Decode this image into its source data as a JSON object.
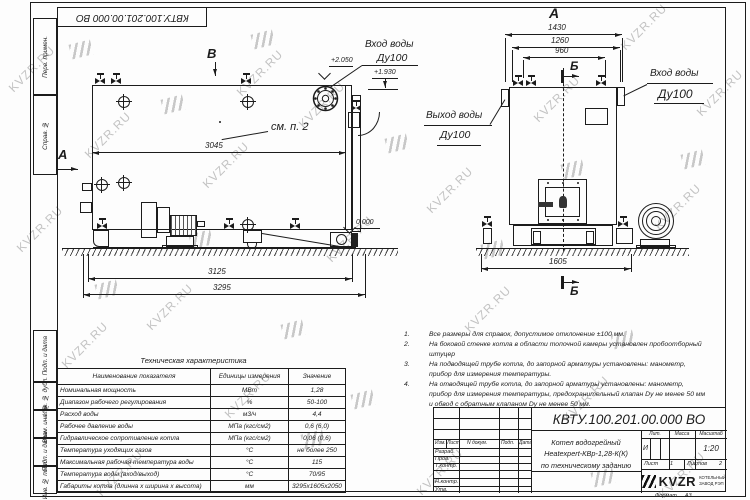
{
  "watermark": {
    "text": "KVZR.RU"
  },
  "frame": {
    "doc_number_top": "КВТУ.100.201.00.000 ВО",
    "format_label": "Формат",
    "format_value": "А3",
    "margin_boxes": [
      "Перв. примен.",
      "Справ. №",
      "Подп. и дата",
      "Инв. № дубл.",
      "Взам. инв. №",
      "Подп. и дата",
      "Инв. № подл."
    ]
  },
  "side_view": {
    "view_mark_b": "В",
    "view_mark_a": "А",
    "callout_see_p2": "см. п. 2",
    "inlet_label": "Вход воды",
    "inlet_dn": "Ду100",
    "lvl_top": "+2.050",
    "lvl_flange": "+1.930",
    "lvl_zero": "0.000",
    "dim_3045": "3045",
    "dim_3125": "3125",
    "dim_3295": "3295"
  },
  "front_view": {
    "view_label": "А",
    "section_mark": "Б",
    "outlet_label": "Выход воды",
    "outlet_dn": "Ду100",
    "inlet_label": "Вход воды",
    "inlet_dn": "Ду100",
    "dim_1430": "1430",
    "dim_1260": "1260",
    "dim_960": "960",
    "dim_1605": "1605"
  },
  "notes": [
    {
      "n": "1.",
      "text": "Все размеры для справок, допустимое отклонение ±100 мм."
    },
    {
      "n": "2.",
      "text": "На боковой стенке котла в области топочной камеры установлен пробоотборный штуцер"
    },
    {
      "n": "3.",
      "text": "На подводящей трубе котла, до запорной арматуры установлены: манометр, прибор для измерения температуры."
    },
    {
      "n": "4.",
      "text": "На отводящей трубе котла, до запорной арматуры установлены: манометр, прибор для измерения температуры, предохранительный клапан Dу не менее 50 мм и обвод с обратным клапаном Dу не менее 50 мм."
    }
  ],
  "spec_table": {
    "title": "Техническая характеристика",
    "headers": [
      "Наименование показателя",
      "Единицы измерения",
      "Значение"
    ],
    "rows": [
      [
        "Номинальная мощность",
        "МВт",
        "1,28"
      ],
      [
        "Диапазон рабочего регулирования",
        "%",
        "50-100"
      ],
      [
        "Расход воды",
        "м3/ч",
        "4,4"
      ],
      [
        "Рабочее давление воды",
        "МПа (кгс/см2)",
        "0,6 (6,0)"
      ],
      [
        "Гидравлическое сопротивление котла",
        "МПа (кгс/см2)",
        "0,06 (0,6)"
      ],
      [
        "Температура уходящих газов",
        "°С",
        "не более 250"
      ],
      [
        "Максимальная рабочая температура воды",
        "°С",
        "115"
      ],
      [
        "Температура воды (вход/выход)",
        "°С",
        "70/95"
      ],
      [
        "Габариты котла (длинна х ширина х высота)",
        "мм",
        "3295х1605х2050"
      ]
    ]
  },
  "title_block": {
    "doc_number": "КВТУ.100.201.00.000 ВО",
    "product_line1": "Котел водогрейный",
    "product_line2": "Heatexpert-КВр-1,28-К(К)",
    "product_line3": "по техническому заданию",
    "col_izm": "Изм.",
    "col_list": "Лист",
    "col_ndoc": "N докум.",
    "col_podp": "Подп.",
    "col_data": "Дата",
    "row_razrab": "Разраб.",
    "row_prov": "Пров.",
    "row_tkontr": "Т.контр.",
    "row_nkontr": "Н.контр.",
    "row_utv": "Утв.",
    "lit_label": "Лит.",
    "lit_value": "И",
    "massa_label": "Масса",
    "masshtab_label": "Масштаб",
    "masshtab_value": "1:20",
    "list_label": "Лист",
    "list_value": "1",
    "listov_label": "Листов",
    "listov_value": "2",
    "logo_text": "KVZR",
    "logo_sub1": "КОТЕЛЬНЫЙ",
    "logo_sub2": "ЗАВОД РЭП"
  },
  "colors": {
    "line": "#1c1c1c",
    "watermark": "#c3c3c3"
  }
}
